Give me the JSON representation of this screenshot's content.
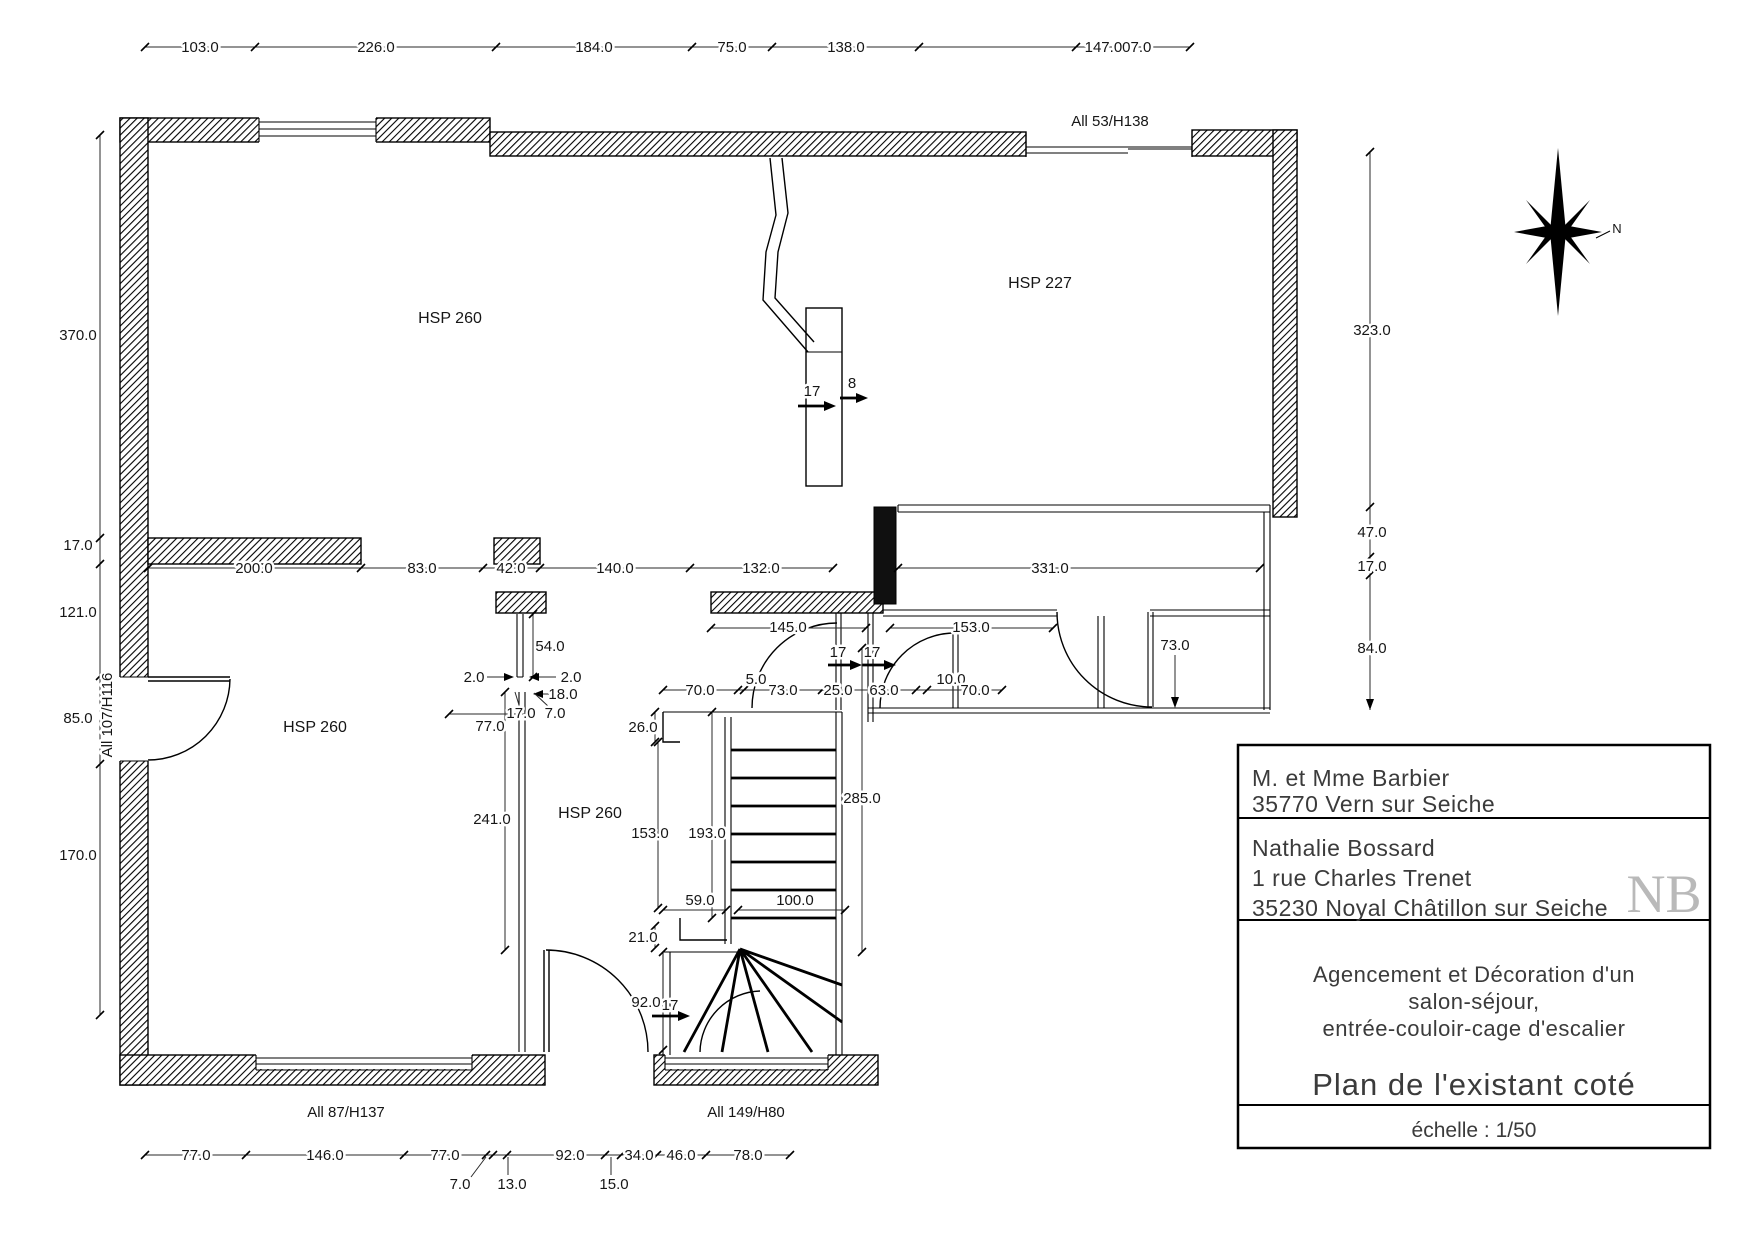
{
  "dims": {
    "top": [
      "103.0",
      "226.0",
      "184.0",
      "75.0",
      "138.0",
      "147.007.0"
    ],
    "left": [
      "370.0",
      "17.0",
      "121.0",
      "85.0",
      "170.0"
    ],
    "right": [
      "323.0",
      "47.0",
      "17.0",
      "84.0"
    ],
    "mid": [
      "200.0",
      "83.0",
      "42.0",
      "140.0",
      "132.0",
      "331.0"
    ],
    "corridor": {
      "w145": "145.0",
      "w153": "153.0",
      "row": [
        "70.0",
        "5.0",
        "73.0",
        "25.0",
        "63.0",
        "10.0",
        "70.0"
      ],
      "v73": "73.0",
      "t17a": "17",
      "t17b": "17"
    },
    "flue": {
      "t17": "17",
      "t8": "8"
    },
    "partition": {
      "d54": "54.0",
      "d2a": "2.0",
      "d2b": "2.0",
      "d18": "18.0",
      "d17": "17.0",
      "d7": "7.0",
      "d77": "77.0",
      "d241": "241.0"
    },
    "stair": {
      "d26": "26.0",
      "d153": "153.0",
      "d193": "193.0",
      "d285": "285.0",
      "d59": "59.0",
      "d100": "100.0",
      "d21": "21.0",
      "d92": "92.0",
      "t17": "17"
    },
    "bottom": [
      "77.0",
      "146.0",
      "77.0",
      "92.0",
      "34.0",
      "46.0",
      "78.0"
    ],
    "bottom_sub": [
      "7.0",
      "13.0",
      "15.0"
    ]
  },
  "rooms": {
    "living": "HSP 260",
    "sejour": "HSP 227",
    "room_sw": "HSP 260",
    "room_s": "HSP 260"
  },
  "openings": {
    "left": "All 107/H116",
    "top": "All 53/H138",
    "bottom_left": "All 87/H137",
    "bottom_mid": "All 149/H80"
  },
  "compass": {
    "north": "N"
  },
  "title_block": {
    "client": [
      "M. et Mme Barbier",
      "35770 Vern sur Seiche"
    ],
    "designer": [
      "Nathalie Bossard",
      "1 rue Charles Trenet",
      "35230 Noyal Châtillon sur Seiche"
    ],
    "project": [
      "Agencement et Décoration d'un",
      "salon-séjour,",
      "entrée-couloir-cage d'escalier"
    ],
    "plan_title": "Plan de l'existant coté",
    "scale": "échelle : 1/50",
    "logo": "NB"
  }
}
